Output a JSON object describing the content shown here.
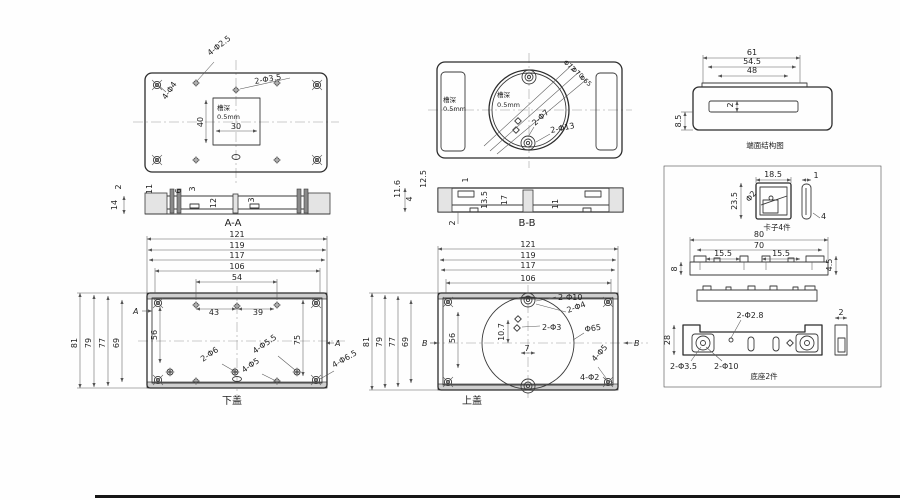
{
  "title": "enclosure-engineering-drawing",
  "views": {
    "top_left": {
      "labels": {
        "holes_a": "4-Φ2.5",
        "holes_b": "4-Φ4",
        "holes_c": "2-Φ3.5",
        "slot_l1": "槽深",
        "slot_l2": "0.5mm"
      },
      "dims": {
        "d30": "30",
        "d40": "40"
      }
    },
    "top_mid": {
      "labels": {
        "slot_l1": "槽深",
        "slot_l2": "0.5mm",
        "slot2_l1": "槽深",
        "slot2_l2": "0.5mm",
        "d72": "Φ72",
        "d70": "Φ70",
        "d65": "Φ65",
        "holes_a": "2-Φ7",
        "holes_b": "2-Φ13"
      }
    },
    "end_face": {
      "caption": "端面结构图",
      "dims": {
        "d61": "61",
        "d545": "54.5",
        "d48": "48",
        "d2": "2",
        "d85": "8.5"
      }
    },
    "section_aa": {
      "caption": "A-A",
      "dims": {
        "d2": "2",
        "d14": "14",
        "d11": "11",
        "d6": "6",
        "d3a": "3",
        "d12": "12",
        "d3b": "3"
      }
    },
    "section_bb": {
      "caption": "B-B",
      "dims": {
        "d125": "12.5",
        "d116": "11.6",
        "d4": "4",
        "d1": "1",
        "d135": "13.5",
        "d17": "17",
        "d11": "11",
        "d2": "2"
      }
    },
    "bottom_cover": {
      "caption": "下盖",
      "marker": "A",
      "dims": {
        "d121": "121",
        "d119": "119",
        "d117": "117",
        "d106": "106",
        "d54": "54",
        "d43": "43",
        "d39": "39",
        "d81": "81",
        "d79": "79",
        "d77": "77",
        "d69": "69",
        "d56": "56",
        "d75": "75"
      },
      "labels": {
        "holes_a": "2-Φ6",
        "holes_b": "4-Φ5",
        "holes_c": "4-Φ5.5",
        "holes_d": "4-Φ6.5"
      }
    },
    "top_cover": {
      "caption": "上盖",
      "marker": "B",
      "dims": {
        "d121": "121",
        "d119": "119",
        "d117": "117",
        "d106": "106",
        "d81": "81",
        "d79": "79",
        "d77": "77",
        "d69": "69",
        "d56": "56",
        "d107": "10.7",
        "d7": "7"
      },
      "labels": {
        "holes_a": "2-Φ10",
        "holes_b": "2-Φ4",
        "holes_c": "2-Φ3",
        "d65": "Φ65",
        "holes_d": "4-Φ5",
        "holes_e": "4-Φ2"
      }
    },
    "parts_panel": {
      "clip": {
        "caption": "卡子4件",
        "dims": {
          "d185": "18.5",
          "d235": "23.5",
          "dphi2": "Φ2",
          "d1": "1",
          "d4": "4"
        }
      },
      "rail": {
        "dims": {
          "d80": "80",
          "d70": "70",
          "d155a": "15.5",
          "d155b": "15.5",
          "d8": "8",
          "d45": "4.5"
        }
      },
      "base": {
        "caption": "底座2件",
        "dims": {
          "d28": "28",
          "d2": "2"
        },
        "labels": {
          "holes_top": "2-Φ2.8",
          "holes_a": "2-Φ3.5",
          "holes_b": "2-Φ10"
        }
      }
    }
  }
}
